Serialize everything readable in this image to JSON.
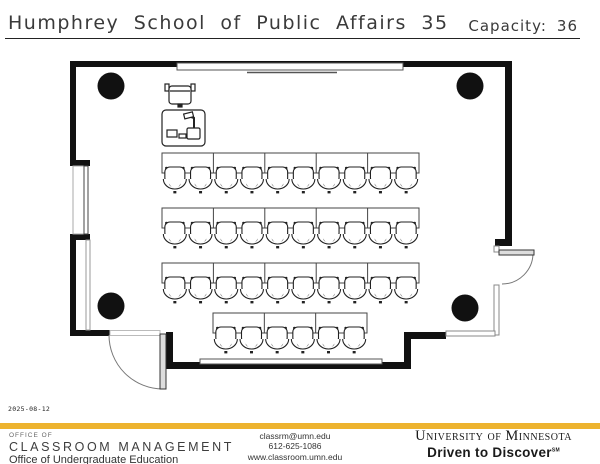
{
  "header": {
    "title": "Humphrey School of Public Affairs 35",
    "capacity_label": "Capacity:",
    "capacity_value": "36"
  },
  "floorplan": {
    "rows": [
      {
        "x": 162,
        "y": 153,
        "width": 257,
        "seats": 10
      },
      {
        "x": 162,
        "y": 208,
        "width": 257,
        "seats": 10
      },
      {
        "x": 162,
        "y": 263,
        "width": 257,
        "seats": 10
      },
      {
        "x": 213,
        "y": 313,
        "width": 154,
        "seats": 6
      }
    ],
    "columns": [
      {
        "cx": 111,
        "cy": 86
      },
      {
        "cx": 470,
        "cy": 86
      },
      {
        "cx": 111,
        "cy": 306
      },
      {
        "cx": 465,
        "cy": 308
      }
    ]
  },
  "footer": {
    "date": "2025-08-12",
    "left": {
      "line1": "OFFICE OF",
      "line2": "CLASSROOM MANAGEMENT",
      "line3": "Office of Undergraduate Education"
    },
    "contact": {
      "email": "classrm@umn.edu",
      "phone": "612-625-1086",
      "web": "www.classroom.umn.edu"
    },
    "brand": {
      "university": "University of Minnesota",
      "tagline": "Driven to Discover",
      "tagline_mark": "SM"
    }
  },
  "colors": {
    "gold": "#EDB32F",
    "line": "#1a1a1a"
  }
}
